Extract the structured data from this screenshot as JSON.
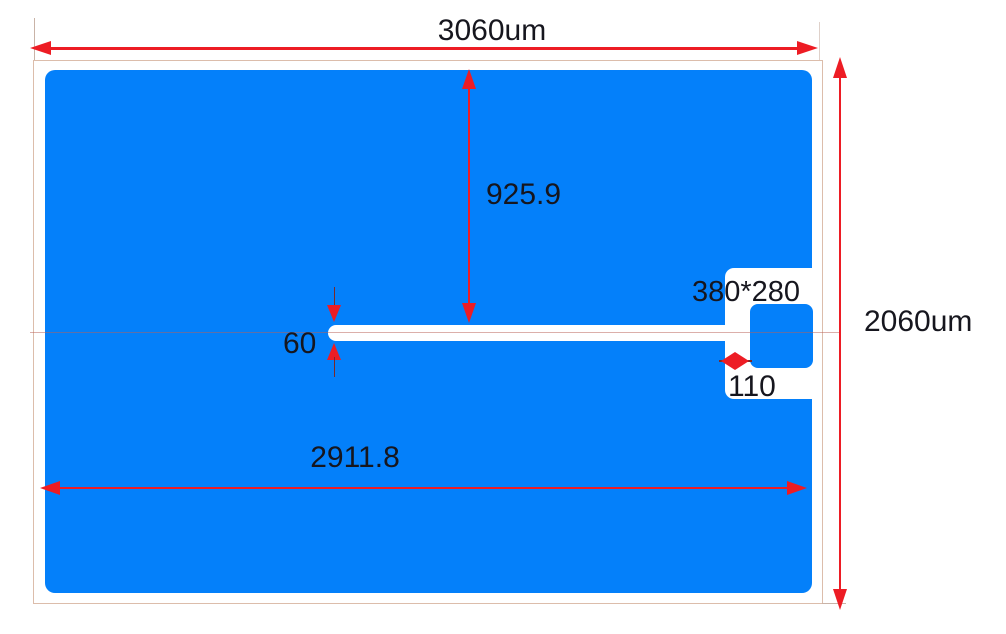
{
  "drawing": {
    "dimensions": {
      "overall_width": "3060um",
      "overall_height": "2060um",
      "slot_inset_from_top": "925.9",
      "slot_height": "60",
      "patch_width": "2911.8",
      "notch_size": "380*280",
      "channel_width": "110"
    },
    "colors": {
      "patch_blue": "#0480fa",
      "dimension_red": "#ed1c24",
      "extension_dark_red": "#7a2a2a",
      "substrate_outline": "#dcbdab",
      "centerline": "#b95f55",
      "label_text": "#16161e"
    }
  }
}
